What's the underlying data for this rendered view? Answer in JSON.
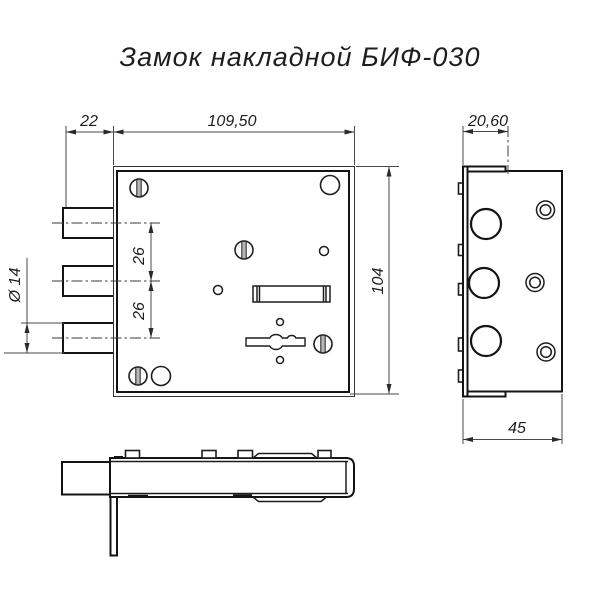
{
  "title": "Замок накладной БИФ-030",
  "drawing": {
    "type": "technical-drawing",
    "product": "surface-mounted lock BIF-030",
    "views": {
      "front": {
        "name": "front-view",
        "dims": {
          "bolt_protrusion": "22",
          "body_width": "109,50",
          "body_height": "104",
          "bolt_pitch_top": "26",
          "bolt_pitch_bottom": "26",
          "bolt_diameter": "Ø 14"
        }
      },
      "side": {
        "name": "side-view",
        "dims": {
          "flange_offset": "20,60",
          "case_depth": "45"
        }
      },
      "bottom": {
        "name": "bottom-view"
      }
    }
  },
  "colors": {
    "background": "#ffffff",
    "contour_line": "#141414",
    "thin_line": "#4a4a4a",
    "screw_slot": "#b5b5b5"
  }
}
